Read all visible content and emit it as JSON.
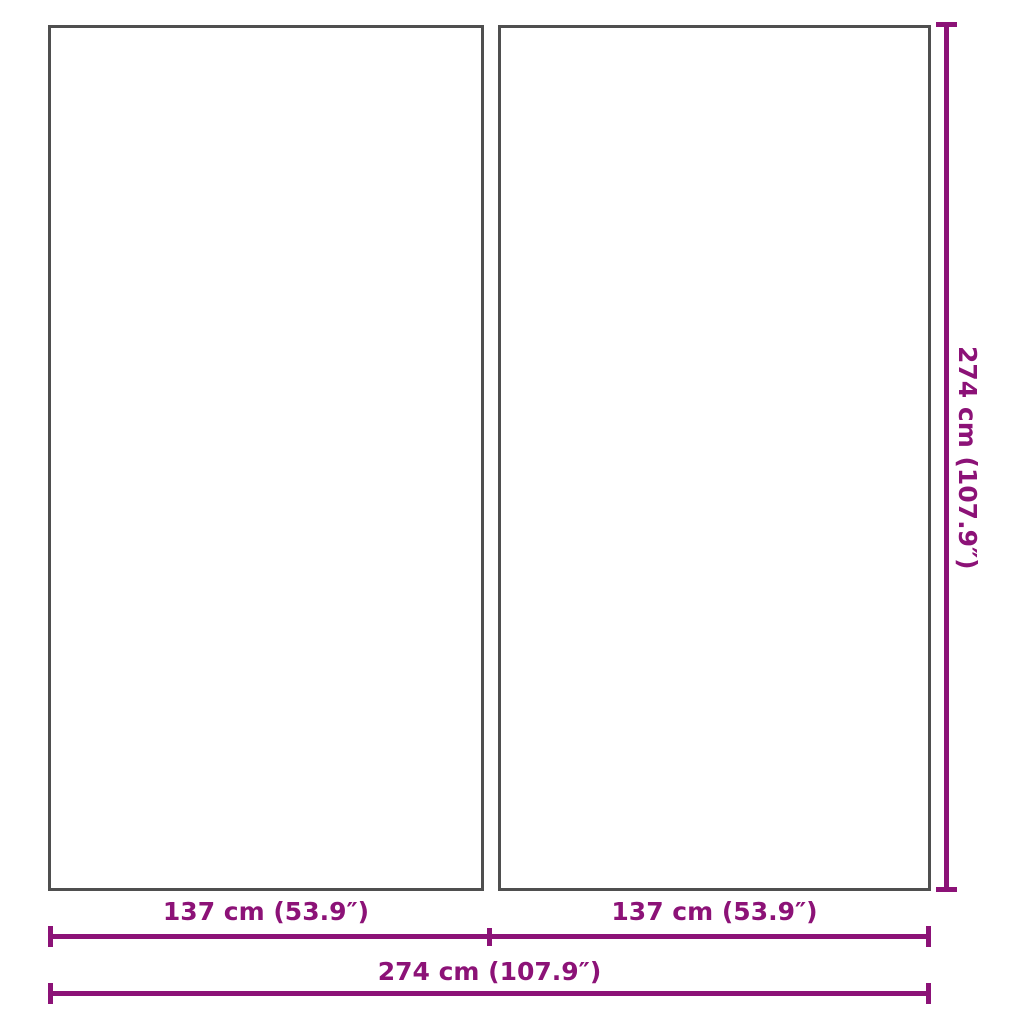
{
  "colors": {
    "accent": "#8C1277",
    "panel_border": "#4F4F4F",
    "background": "#FFFFFF"
  },
  "diagram": {
    "panels": [
      {
        "name": "left-panel"
      },
      {
        "name": "right-panel"
      }
    ],
    "dimensions": {
      "height": {
        "label": "274 cm (107.9″)"
      },
      "width_left": {
        "label": "137 cm (53.9″)"
      },
      "width_right": {
        "label": "137 cm (53.9″)"
      },
      "width_total": {
        "label": "274 cm (107.9″)"
      }
    }
  }
}
